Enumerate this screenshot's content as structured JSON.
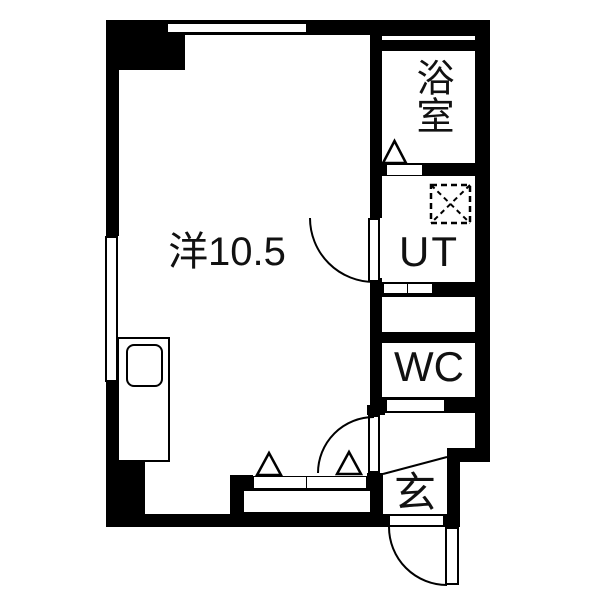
{
  "floorplan": {
    "rooms": {
      "main": {
        "label": "洋10.5"
      },
      "bath": {
        "label": "浴室"
      },
      "utility": {
        "label": "UT"
      },
      "toilet": {
        "label": "WC"
      },
      "entrance": {
        "label": "玄"
      }
    },
    "colors": {
      "wall": "#000000",
      "floor": "#ffffff",
      "line": "#000000"
    }
  }
}
